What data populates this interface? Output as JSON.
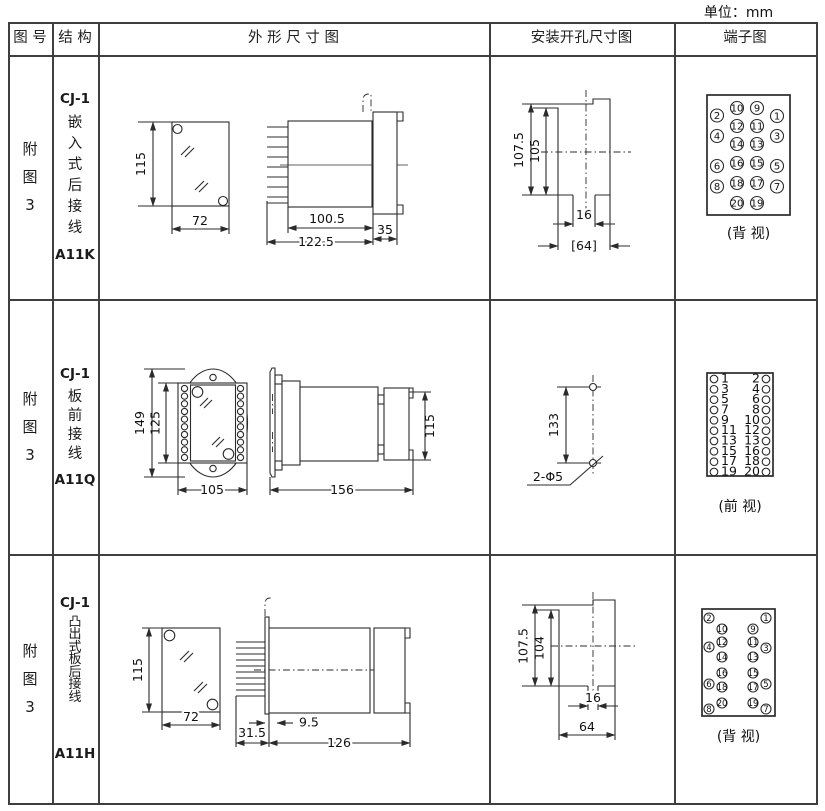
{
  "unit_label": "单位：mm",
  "header": {
    "figure": "图 号",
    "structure": "结 构",
    "outline": "外 形 尺 寸 图",
    "install": "安装开孔尺寸图",
    "terminal": "端子图"
  },
  "rows": [
    {
      "figure_no": [
        "附",
        "图",
        "3"
      ],
      "structure": [
        "CJ-1",
        "嵌",
        "入",
        "式",
        "后",
        "接",
        "线",
        "A11K"
      ],
      "outline": {
        "height": "115",
        "width": "72",
        "depth_body": "100.5",
        "depth_total": "122.5",
        "depth_rear": "35"
      },
      "install": {
        "h_outer": "107.5",
        "h_inner": "105",
        "w_slot": "16",
        "w_span": "[64]"
      },
      "terminal": {
        "view": "(背 视)",
        "outer_left": [
          "2",
          "4",
          "6",
          "8"
        ],
        "inner_left": [
          "10",
          "12",
          "14",
          "16",
          "18",
          "20"
        ],
        "inner_right": [
          "9",
          "11",
          "13",
          "15",
          "17",
          "19"
        ],
        "outer_right": [
          "1",
          "3",
          "5",
          "7"
        ]
      }
    },
    {
      "figure_no": [
        "附",
        "图",
        "3"
      ],
      "structure": [
        "CJ-1",
        "板",
        "前",
        "接",
        "线",
        "A11Q"
      ],
      "outline": {
        "h_outer": "149",
        "h_inner": "125",
        "width": "105",
        "depth": "156",
        "height_side": "115"
      },
      "install": {
        "span": "133",
        "holes": "2-Φ5"
      },
      "terminal": {
        "view": "(前 视)",
        "left": [
          "1",
          "3",
          "5",
          "7",
          "9",
          "11",
          "13",
          "15",
          "17",
          "19"
        ],
        "right": [
          "2",
          "4",
          "6",
          "8",
          "10",
          "12",
          "13",
          "16",
          "18",
          "20"
        ]
      }
    },
    {
      "figure_no": [
        "附",
        "图",
        "3"
      ],
      "structure": [
        "CJ-1",
        "凸",
        "出",
        "式",
        "板",
        "后",
        "接",
        "线",
        "A11H"
      ],
      "outline": {
        "height": "115",
        "width": "72",
        "plate": "31.5",
        "pins": "9.5",
        "depth": "126"
      },
      "install": {
        "h_outer": "107.5",
        "h_inner": "104",
        "w_slot": "16",
        "w_span": "64"
      },
      "terminal": {
        "view": "(背 视)",
        "outer_left": [
          "2",
          "4",
          "6",
          "8"
        ],
        "inner_left": [
          "10",
          "12",
          "14",
          "16",
          "18",
          "20"
        ],
        "inner_right": [
          "9",
          "11",
          "13",
          "15",
          "17",
          "19"
        ],
        "outer_right": [
          "1",
          "3",
          "5",
          "7"
        ]
      }
    }
  ]
}
